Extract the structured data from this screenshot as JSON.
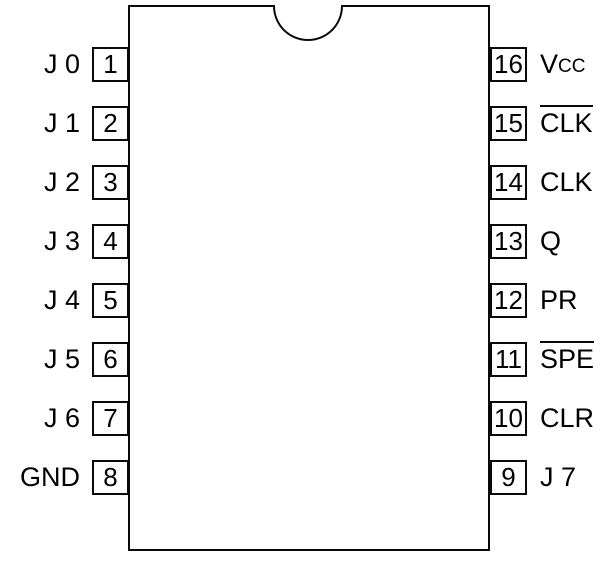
{
  "chip": {
    "pin_count": 16,
    "background_color": "#ffffff",
    "line_color": "#000000",
    "pins": {
      "left": [
        {
          "number": "1",
          "label": "J 0"
        },
        {
          "number": "2",
          "label": "J 1"
        },
        {
          "number": "3",
          "label": "J 2"
        },
        {
          "number": "4",
          "label": "J 3"
        },
        {
          "number": "5",
          "label": "J 4"
        },
        {
          "number": "6",
          "label": "J 5"
        },
        {
          "number": "7",
          "label": "J 6"
        },
        {
          "number": "8",
          "label": "GND"
        }
      ],
      "right": [
        {
          "number": "16",
          "label_base": "V",
          "label_sub": "CC"
        },
        {
          "number": "15",
          "label": "CLK",
          "overline": true
        },
        {
          "number": "14",
          "label": "CLK"
        },
        {
          "number": "13",
          "label": "Q"
        },
        {
          "number": "12",
          "label": "PR"
        },
        {
          "number": "11",
          "label": "SPE",
          "overline": true
        },
        {
          "number": "10",
          "label": "CLR"
        },
        {
          "number": "9",
          "label": "J 7"
        }
      ]
    }
  }
}
